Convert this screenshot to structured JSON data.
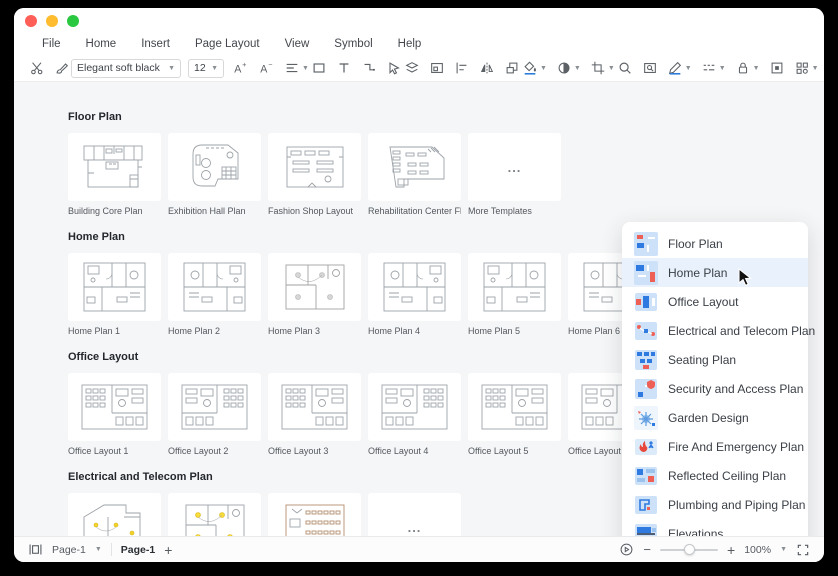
{
  "colors": {
    "accent_blue": "#2f7ae0",
    "panel_selected_bg": "#e8f1fc",
    "traffic_close": "#ff5f57",
    "traffic_minimize": "#febc2e",
    "traffic_zoom": "#2ac840",
    "electrical_symbol_yellow": "#f3d32b"
  },
  "menu": {
    "items": [
      "File",
      "Home",
      "Insert",
      "Page Layout",
      "View",
      "Symbol",
      "Help"
    ]
  },
  "toolbar": {
    "font_family": "Elegant soft black",
    "font_size": "12",
    "icons": [
      "cut",
      "format-painter",
      "increase-font-size",
      "decrease-font-size",
      "text-align",
      "rectangle-tool",
      "text-tool",
      "connector-tool",
      "select-tool",
      "layers",
      "container",
      "align-objects",
      "mirror",
      "bring-forward",
      "fill-color",
      "shape-style",
      "crop",
      "search",
      "find-replace",
      "pen-color",
      "line-style",
      "lock",
      "frame",
      "view-options"
    ]
  },
  "gallery": {
    "sections": [
      {
        "title": "Floor Plan",
        "templates": [
          "Building Core Plan",
          "Exhibition Hall Plan",
          "Fashion Shop Layout",
          "Rehabilitation Center Floor Pl.."
        ],
        "more_label": "More Templates",
        "more_dots": "..."
      },
      {
        "title": "Home Plan",
        "templates": [
          "Home Plan 1",
          "Home Plan 2",
          "Home Plan 3",
          "Home Plan 4",
          "Home Plan 5",
          "Home Plan 6"
        ]
      },
      {
        "title": "Office Layout",
        "templates": [
          "Office Layout 1",
          "Office Layout 2",
          "Office Layout 3",
          "Office Layout 4",
          "Office Layout 5",
          "Office Layout 6"
        ]
      },
      {
        "title": "Electrical and Telecom Plan",
        "templates": [],
        "more_dots": "..."
      }
    ]
  },
  "category_panel": {
    "items": [
      {
        "label": "Floor Plan",
        "selected": false
      },
      {
        "label": "Home Plan",
        "selected": true
      },
      {
        "label": "Office Layout",
        "selected": false
      },
      {
        "label": "Electrical and Telecom Plan",
        "selected": false
      },
      {
        "label": "Seating Plan",
        "selected": false
      },
      {
        "label": "Security and Access Plan",
        "selected": false
      },
      {
        "label": "Garden Design",
        "selected": false
      },
      {
        "label": "Fire And Emergency Plan",
        "selected": false
      },
      {
        "label": "Reflected Ceiling Plan",
        "selected": false
      },
      {
        "label": "Plumbing and Piping Plan",
        "selected": false
      },
      {
        "label": "Elevations",
        "selected": false
      },
      {
        "label": "Wardrobe",
        "selected": false
      }
    ]
  },
  "statusbar": {
    "page_selector": "Page-1",
    "active_page_tab": "Page-1",
    "add_page": "+",
    "zoom_level": "100%"
  }
}
